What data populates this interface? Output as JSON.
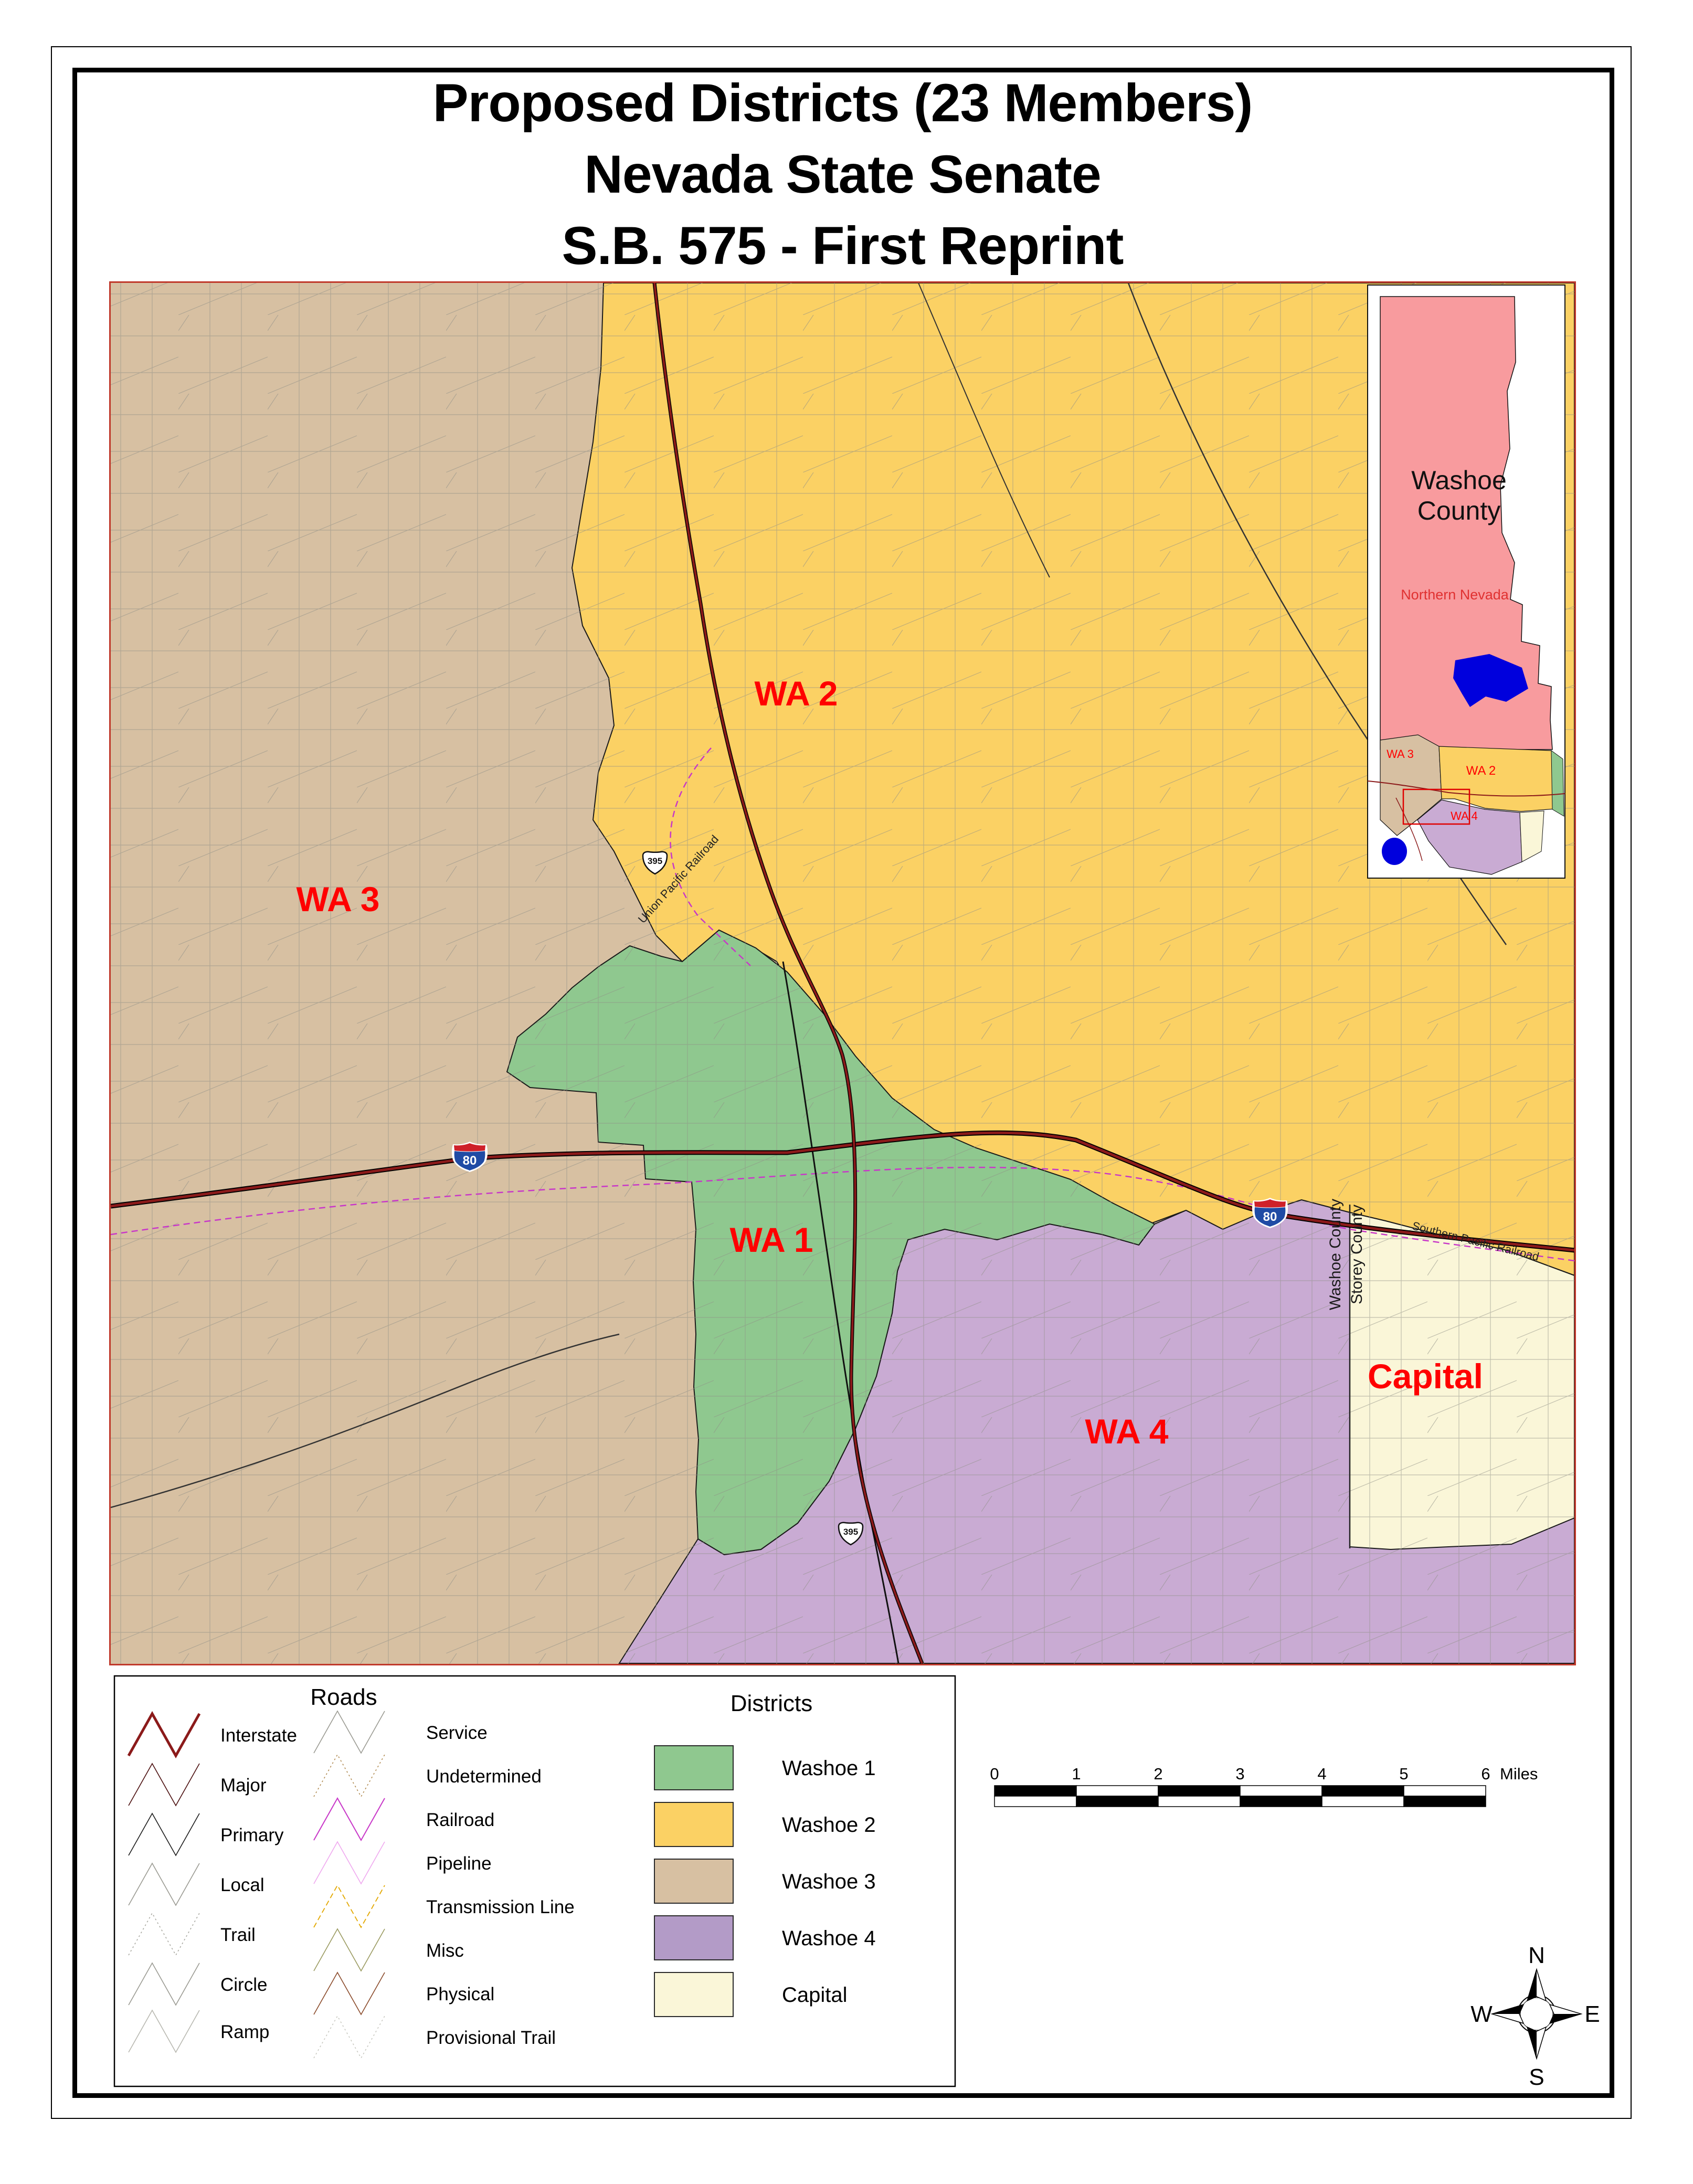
{
  "title": {
    "line1": "Proposed Districts (23 Members)",
    "line2": "Nevada State Senate",
    "line3": "S.B. 575 - First Reprint"
  },
  "map": {
    "labels": {
      "wa1": "WA 1",
      "wa2": "WA 2",
      "wa3": "WA 3",
      "wa4": "WA 4",
      "capital": "Capital"
    },
    "counties": {
      "washoe": "Washoe County",
      "storey": "Storey County"
    },
    "railroads": {
      "southern_pacific": "Southern Pacific Railroad",
      "union_pacific": "Union Pacific Railroad"
    },
    "shields": {
      "interstate": "80",
      "us_route": "395"
    }
  },
  "inset": {
    "title_line1": "Washoe",
    "title_line2": "County",
    "subtitle": "Northern Nevada",
    "labels": {
      "wa3": "WA 3",
      "wa2": "WA 2",
      "wa4": "WA 4"
    }
  },
  "legend": {
    "roads": {
      "title": "Roads",
      "left": [
        {
          "label": "Interstate",
          "color": "#8B1A1A"
        },
        {
          "label": "Major",
          "color": "#4A0E0E"
        },
        {
          "label": "Primary",
          "color": "#1A1A1A"
        },
        {
          "label": "Local",
          "color": "#9A9A92"
        },
        {
          "label": "Trail",
          "color": "#A8A8A0"
        },
        {
          "label": "Circle",
          "color": "#9A9A92"
        },
        {
          "label": "Ramp",
          "color": "#B8B8B0"
        }
      ],
      "right": [
        {
          "label": "Service",
          "color": "#9A9A92"
        },
        {
          "label": "Undetermined",
          "color": "#B08A50"
        },
        {
          "label": "Railroad",
          "color": "#C837C8"
        },
        {
          "label": "Pipeline",
          "color": "#EFA9EF"
        },
        {
          "label": "Transmission Line",
          "color": "#E3A800"
        },
        {
          "label": "Misc",
          "color": "#9A9A60"
        },
        {
          "label": "Physical",
          "color": "#8A4A2A"
        },
        {
          "label": "Provisional Trail",
          "color": "#C8C8C0"
        }
      ]
    },
    "districts": {
      "title": "Districts",
      "items": [
        {
          "label": "Washoe 1",
          "color": "#8FC88F"
        },
        {
          "label": "Washoe 2",
          "color": "#FBD164"
        },
        {
          "label": "Washoe 3",
          "color": "#D7C0A2"
        },
        {
          "label": "Washoe 4",
          "color": "#B39BC7"
        },
        {
          "label": "Capital",
          "color": "#FAF6D8"
        }
      ]
    }
  },
  "scale_bar": {
    "ticks": [
      "0",
      "1",
      "2",
      "3",
      "4",
      "5",
      "6"
    ],
    "unit": "Miles"
  },
  "compass": {
    "n": "N",
    "s": "S",
    "e": "E",
    "w": "W"
  },
  "colors": {
    "washoe1": "#8FC88F",
    "washoe2": "#FBD164",
    "washoe3": "#D7C0A2",
    "washoe4_map": "#C9ABD3",
    "capital": "#FAF6D8",
    "inset_pink": "#F89B9E",
    "lake_blue": "#0000DD",
    "label_red": "#FF0000",
    "interstate": "#8B1A1A",
    "railroad": "#C837C8",
    "map_border": "#C0392B"
  }
}
